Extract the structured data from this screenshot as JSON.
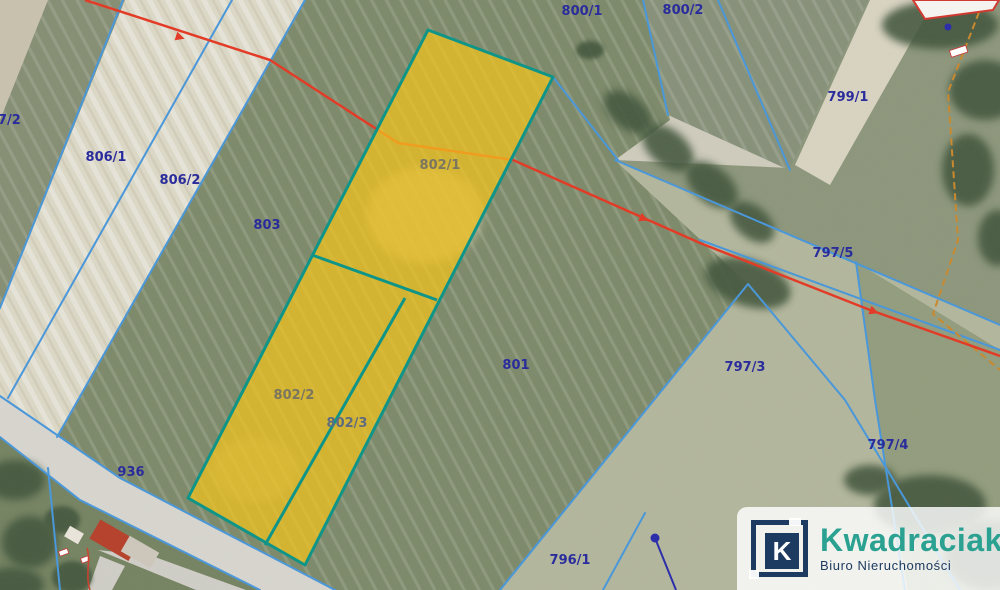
{
  "map": {
    "type": "cadastral-aerial-overlay",
    "parcels": {
      "p7_2": "7/2",
      "p806_1": "806/1",
      "p806_2": "806/2",
      "p803": "803",
      "p800_1": "800/1",
      "p800_2": "800/2",
      "p799_1": "799/1",
      "p802_1": "802/1",
      "p802_2": "802/2",
      "p802_3": "802/3",
      "p801": "801",
      "p797_5": "797/5",
      "p797_3": "797/3",
      "p797_4": "797/4",
      "p796_1": "796/1",
      "p936": "936",
      "p846": "846"
    },
    "highlighted_parcels": [
      "802/1",
      "802/2",
      "802/3"
    ],
    "colors": {
      "highlight_fill": "#f4c41c",
      "highlight_border": "#0f9488",
      "boundary_line": "#4a97d9",
      "utility_line_red": "#e23c28",
      "secondary_line_orange": "#c9892f",
      "parcel_label": "#2a2c9c",
      "highlight_label": "#7a7660",
      "building_outline": "#d03a30"
    }
  },
  "logo": {
    "mark": "K",
    "brand": "Kwadraciak",
    "tagline": "Biuro Nieruchomości",
    "brand_color": "#2aa191",
    "navy_color": "#1d3a60"
  }
}
